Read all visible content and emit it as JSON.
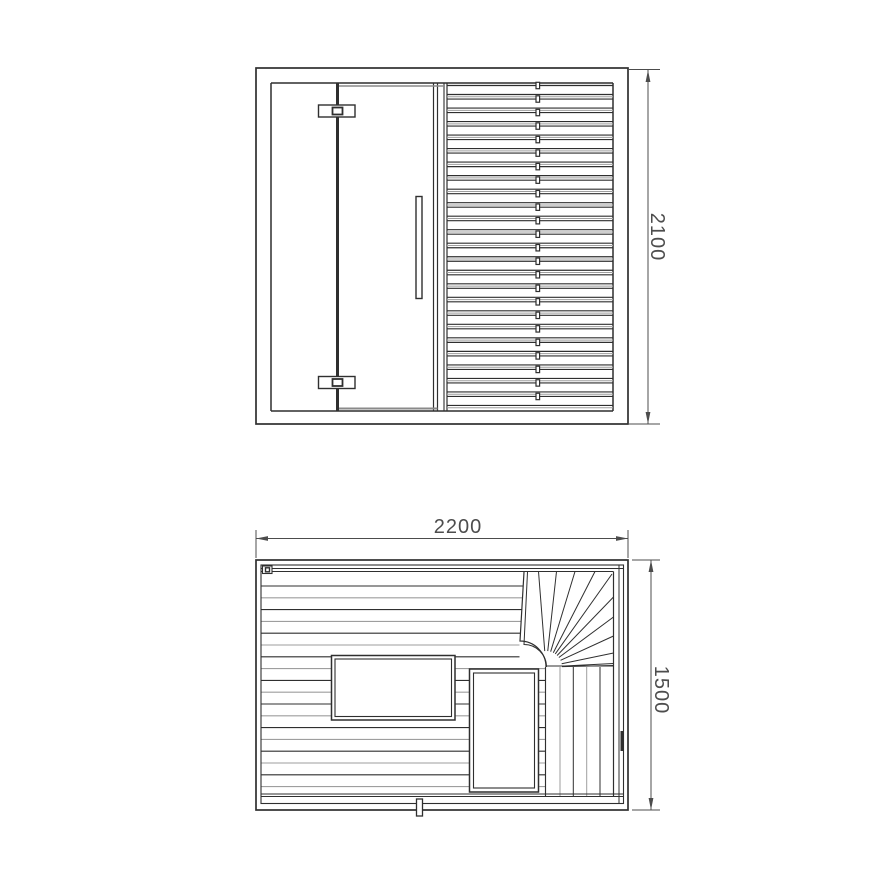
{
  "page": {
    "background": "#ffffff",
    "width": 886,
    "height": 886
  },
  "colors": {
    "line": "#2f2f2f",
    "line_light": "#9e9e9e",
    "line_mid": "#8a8a8a",
    "dim": "#4c4c4c",
    "text": "#4d4d4d",
    "fill": "#ffffff"
  },
  "front_view": {
    "frame": {
      "x": 256,
      "y": 68,
      "right": 628,
      "bottom": 424
    },
    "inner": {
      "left": 271,
      "top": 83,
      "right": 613,
      "bottom": 411
    },
    "hinge_axis": {
      "x": 337.5,
      "w": 3
    },
    "door": {
      "right1": 433.5,
      "right2": 437.5,
      "slat_edge1": 444,
      "slat_edge2": 447,
      "top_y": 86,
      "bottom_y": 408.5
    },
    "handle": {
      "x": 416,
      "y": 196.5,
      "w": 6,
      "h": 102
    },
    "hinges": {
      "x": 318.5,
      "w": 36.5,
      "h": 12,
      "ys": [
        105,
        376.5
      ],
      "square_w": 10,
      "square_h": 7
    },
    "slats": {
      "left": 447,
      "right": 613,
      "top": 85.5,
      "count": 24,
      "pitch": 13.52,
      "board_h": 9,
      "shadow_dy": 11.3,
      "tick_x": 537.8,
      "tick_w": 3.6,
      "tick_h": 6.4
    },
    "dimension": {
      "label": "2100",
      "line_x": 648,
      "y1": 70,
      "y2": 424,
      "ext_x1": 629,
      "ext_x2": 660,
      "label_x": 651,
      "label_y": 237,
      "font_size": 20
    }
  },
  "plan_view": {
    "wall": {
      "x": 256,
      "y": 560,
      "right": 628,
      "bottom": 810
    },
    "wall_inner": {
      "x": 261,
      "y": 565,
      "right": 623.5,
      "bottom": 803.5
    },
    "right_inner_x": 619,
    "top_edge_y1": 568.5,
    "top_edge_y2": 571.5,
    "bottom_edge_y1": 794,
    "bottom_edge_y2": 796.5,
    "corner_detail": {
      "x": 262.5,
      "y": 566,
      "w": 9.5,
      "h": 7.5,
      "sq": 4
    },
    "h_boards": {
      "x0": 261,
      "y0": 586,
      "pitch": 11.8,
      "count": 18,
      "x_end_low": 545.5,
      "x_end_mid": 519.5
    },
    "fan": {
      "pivot": [
        546,
        667
      ],
      "boundary_outer": "M 524 572 L 520 641 A 26 26 0 0 1 546 667",
      "boundary_inner": "M 527.5 572 L 524 644.5 A 22.5 22.5 0 0 1 546.5 667",
      "top_rays_x": [
        538.5,
        556.5,
        575,
        595
      ],
      "top_y": 571.5,
      "corner_ray": [
        612,
        574
      ],
      "right_rays_y": [
        597,
        617,
        636,
        653,
        663.5
      ],
      "right_x": 613.5,
      "ray_trim": 16
    },
    "v_boards": {
      "xs": [
        560,
        573.3,
        586.7,
        600
      ],
      "left_x": 545.5,
      "edge_x": 613.5,
      "y0": 667,
      "y1": 796.5,
      "edge_y0": 571.5
    },
    "rect_left": {
      "x": 331.5,
      "y": 655.5,
      "w": 123.5,
      "h": 64.5,
      "inset": 3.5
    },
    "rect_right": {
      "x": 469.5,
      "y": 669,
      "w": 69,
      "h": 123,
      "inset": 4
    },
    "drain": {
      "x": 416.5,
      "y": 799,
      "w": 6,
      "h": 17
    },
    "door_handle": {
      "x": 620.5,
      "y": 731,
      "w": 3.5,
      "h": 20
    },
    "dim_width": {
      "label": "2200",
      "line_y": 538.5,
      "x1": 256,
      "x2": 628,
      "ext_y1": 530,
      "ext_y2": 558,
      "label_x": 458,
      "label_y": 533,
      "font_size": 20
    },
    "dim_depth": {
      "label": "1500",
      "line_x": 651,
      "y1": 560,
      "y2": 810,
      "ext_x1": 632,
      "ext_x2": 660,
      "label_x": 655,
      "label_y": 690,
      "font_size": 20
    }
  }
}
